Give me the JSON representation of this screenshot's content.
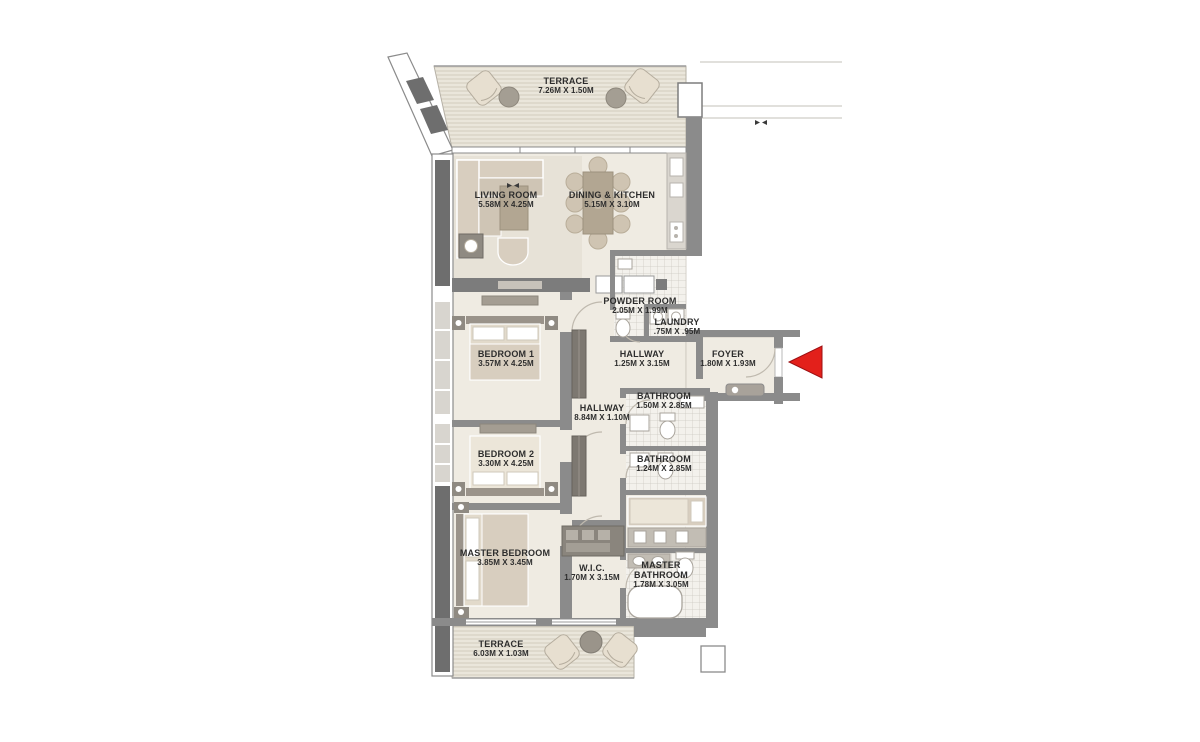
{
  "plan_title": "3 Bedroom Apartment Floor Plan",
  "rooms": [
    {
      "name": "TERRACE",
      "dims": "7.26M X 1.50M"
    },
    {
      "name": "LIVING ROOM",
      "dims": "5.58M X 4.25M"
    },
    {
      "name": "DINING & KITCHEN",
      "dims": "5.15M X 3.10M"
    },
    {
      "name": "POWDER ROOM",
      "dims": "2.05M X 1.99M"
    },
    {
      "name": "LAUNDRY",
      "dims": ".75M X .95M"
    },
    {
      "name": "HALLWAY",
      "dims": "1.25M X 3.15M"
    },
    {
      "name": "FOYER",
      "dims": "1.80M X 1.93M"
    },
    {
      "name": "BEDROOM 1",
      "dims": "3.57M X 4.25M"
    },
    {
      "name": "HALLWAY",
      "dims": "8.84M X 1.10M"
    },
    {
      "name": "BATHROOM",
      "dims": "1.50M X 2.85M"
    },
    {
      "name": "BATHROOM",
      "dims": "1.24M X 2.85M"
    },
    {
      "name": "BEDROOM 2",
      "dims": "3.30M X 4.25M"
    },
    {
      "name": "MASTER BEDROOM",
      "dims": "3.85M X 3.45M"
    },
    {
      "name": "W.I.C.",
      "dims": "1.70M X 3.15M"
    },
    {
      "name": "MASTER BATHROOM",
      "dims": "1.78M X 3.05M"
    },
    {
      "name": "TERRACE",
      "dims": "6.03M X 1.03M"
    }
  ],
  "markers": {
    "entry_arrow": "entry-direction-arrow"
  },
  "colors": {
    "wall": "#8b8b8b",
    "wall_dark": "#6e6e6e",
    "floor": "#efebe2",
    "terrace_base": "#eae6db",
    "terrace_stripe": "#d7d1c3",
    "tile": "#f3f1ec",
    "tile_line": "#ccc8c0",
    "furniture": "#d8cebf",
    "furniture_dark": "#b2a692",
    "entry_arrow_red": "#e3201b",
    "label_text": "#2d2d2d"
  }
}
